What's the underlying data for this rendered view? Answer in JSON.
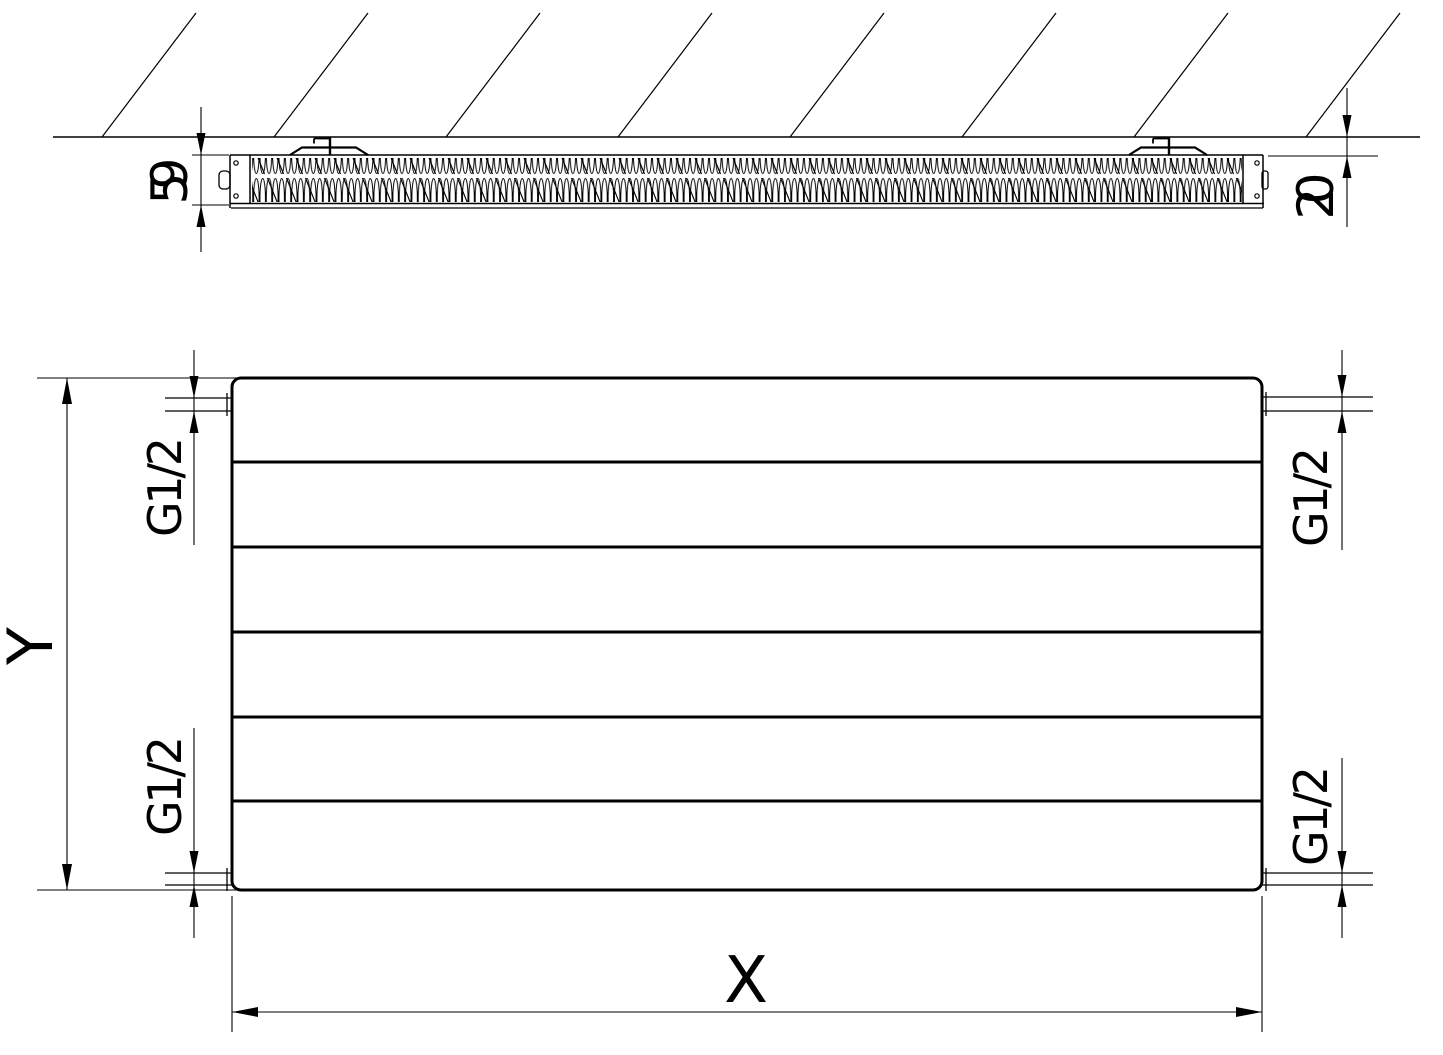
{
  "document": {
    "kind": "radiator technical drawing",
    "views": [
      "side section against wall",
      "front elevation"
    ]
  },
  "colors": {
    "ink": "#000000",
    "background": "#ffffff"
  },
  "side_view": {
    "depth_dim_label": "59",
    "wall_gap_dim_label": "20",
    "hatch_line_count": 8,
    "mounting_bracket_count": 2
  },
  "front_view": {
    "height_dim_label": "Y",
    "width_dim_label": "X",
    "groove_line_count": 5,
    "panel_band_count": 6,
    "connection_labels": {
      "top_left": "G1/2",
      "bottom_left": "G1/2",
      "top_right": "G1/2",
      "bottom_right": "G1/2"
    }
  }
}
